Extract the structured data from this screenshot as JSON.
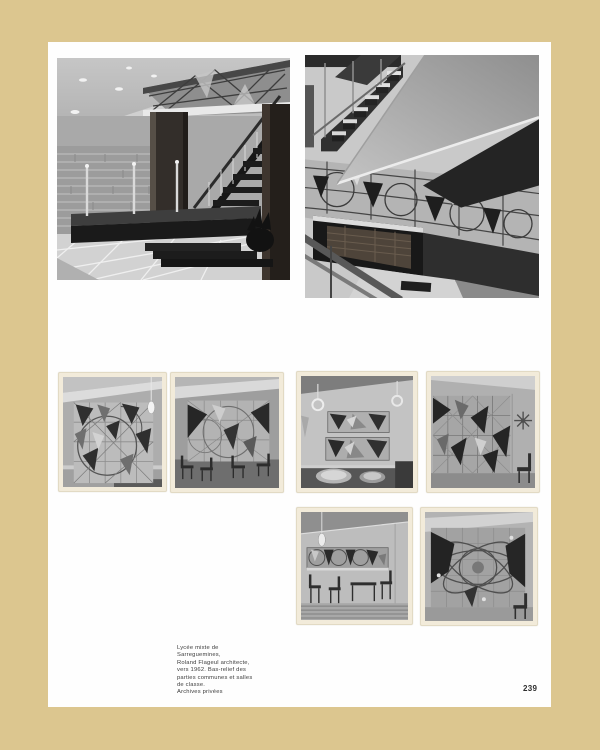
{
  "colors": {
    "backdrop": "#dcc68f",
    "paper": "#fefefe",
    "print_paper": "#f2ebda",
    "caption_text": "#3c3c3c"
  },
  "caption": {
    "lines": [
      "Lycée mixte de",
      "Sarreguemines,",
      "Roland Flageul architecte,",
      "vers 1962. Bas-relief des",
      "parties communes et salles",
      "de classe.",
      "Archives privées"
    ]
  },
  "page_number": "239",
  "photos": {
    "top_left": "lobby-with-floating-staircase-and-glass-mural",
    "top_right": "stairwell-with-geometric-glass-mural-and-brick-pit",
    "middle_left_1": "classroom-wall-mural-grid-circle",
    "middle_left_2": "classroom-mural-with-chairs",
    "middle_right_1": "kitchen-two-mural-panels-pots",
    "middle_right_2": "large-grid-mural-with-starburst",
    "bottom_1": "classroom-mural-band-pendant-lamp",
    "bottom_2": "orbital-ellipse-mural"
  }
}
